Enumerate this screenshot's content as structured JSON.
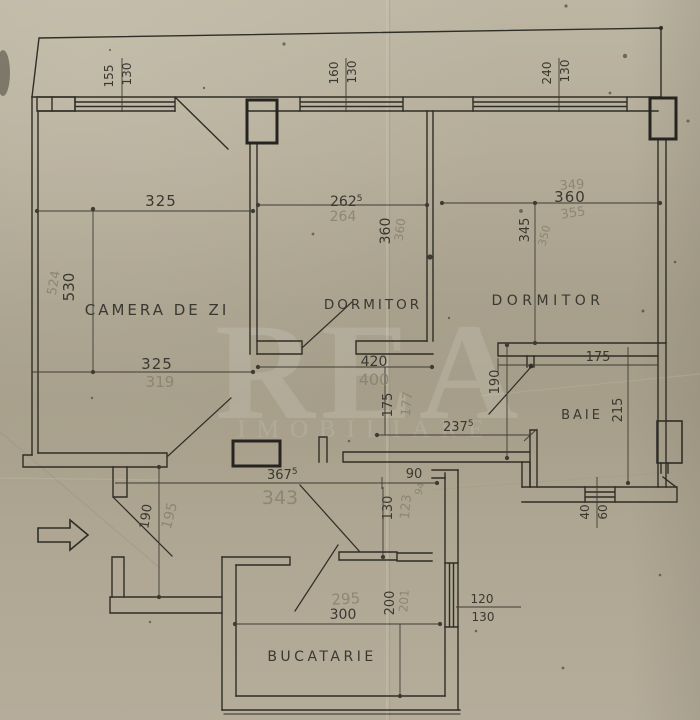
{
  "paper": {
    "bg": "#b3ab97",
    "ink": "#33312b",
    "pencil": "#8a8372"
  },
  "watermark": {
    "line1": "REA",
    "line2": "IMOBILIARE"
  },
  "rooms": {
    "living": "CAMERA DE ZI",
    "bedroom1": "DORMITOR",
    "bedroom2": "DORMITOR",
    "bath": "BAIE",
    "kitchen": "BUCATARIE"
  },
  "windows": {
    "w155": {
      "w": "155",
      "h": "130"
    },
    "w160": {
      "w": "160",
      "h": "130"
    },
    "w240": {
      "w": "240",
      "h": "130"
    },
    "bath": {
      "w": "40",
      "h": "60"
    },
    "kitchen": {
      "w": "120",
      "h": "130"
    }
  },
  "dims": {
    "living": {
      "top": "325",
      "bottom": "325",
      "bottom_pencil": "319",
      "height": "530",
      "height_pencil": "524"
    },
    "bedroom1": {
      "width_main": "262",
      "width_sup": "5",
      "width_pencil": "264",
      "depth": "360",
      "depth_pencil": "360"
    },
    "bedroom2": {
      "width": "360",
      "width_pencil_above": "349",
      "width_pencil_below": "355",
      "depth": "345",
      "depth_pencil": "350"
    },
    "hall": {
      "len420": "420",
      "len420_pencil": "400",
      "h175": "175",
      "h175_pencil": "177",
      "w237_main": "237",
      "w237_sup": "5",
      "total_main": "367",
      "total_sup": "5",
      "total_pencil": "343",
      "pass90": "90",
      "pass90_pencil": "94",
      "pass130": "130",
      "pass130_pencil": "123",
      "door190": "190",
      "entry190": "190",
      "entry190_pencil": "195"
    },
    "bath": {
      "width": "175",
      "depth": "215"
    },
    "kitchen": {
      "width": "300",
      "width_pencil": "295",
      "depth": "200",
      "depth_pencil": "201"
    }
  }
}
